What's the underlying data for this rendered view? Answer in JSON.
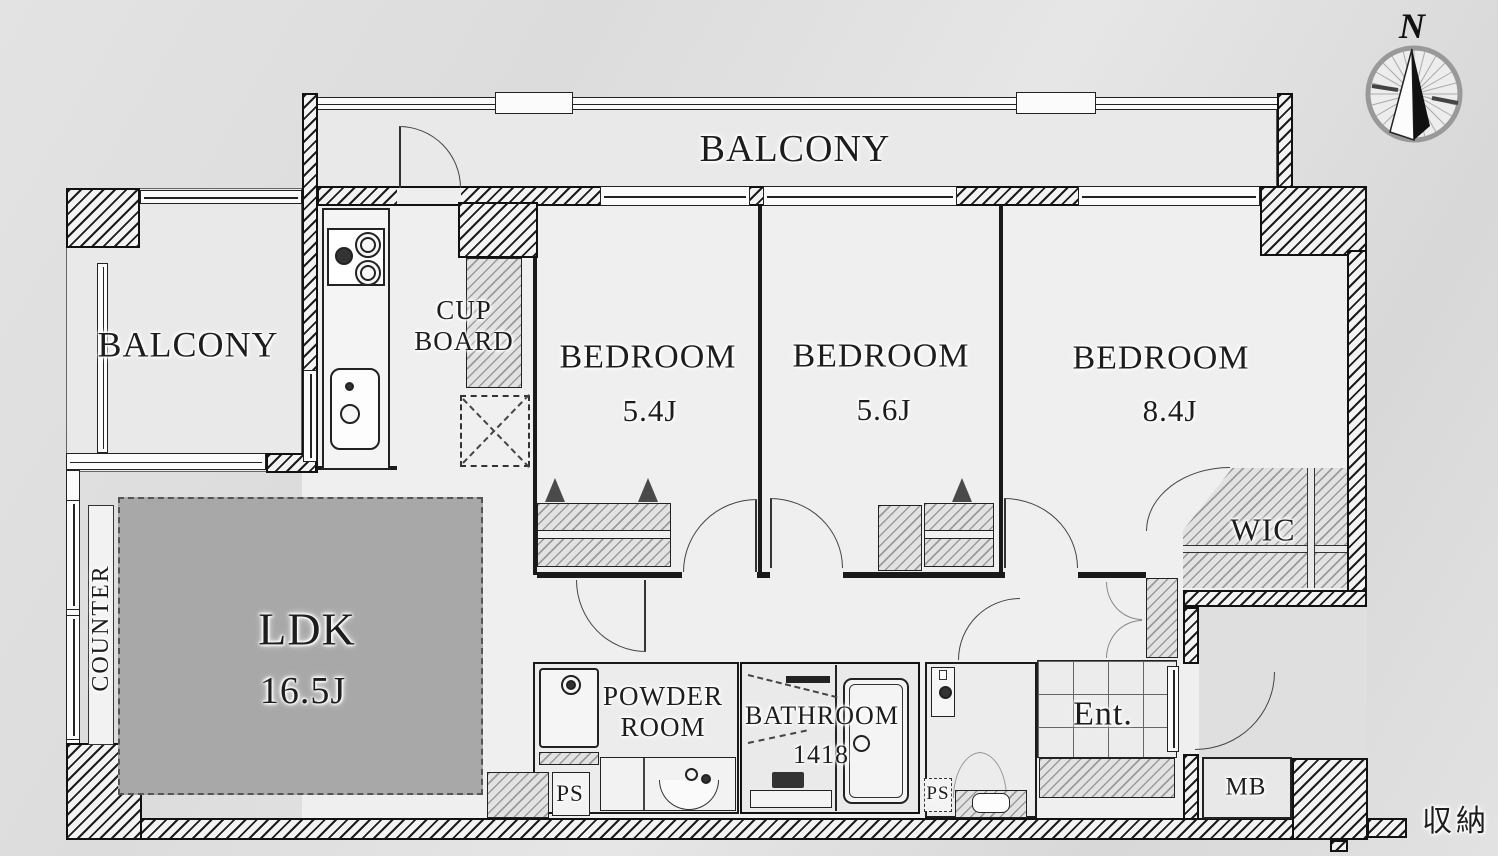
{
  "compass": {
    "north_label": "N"
  },
  "balcony_top": {
    "label": "BALCONY"
  },
  "balcony_left": {
    "label": "BALCONY"
  },
  "cupboard": {
    "line1": "CUP",
    "line2": "BOARD"
  },
  "bedroom_small": {
    "name": "BEDROOM",
    "size": "5.4J"
  },
  "bedroom_mid": {
    "name": "BEDROOM",
    "size": "5.6J"
  },
  "bedroom_large": {
    "name": "BEDROOM",
    "size": "8.4J"
  },
  "wic": {
    "label": "WIC"
  },
  "ldk": {
    "name": "LDK",
    "size": "16.5J"
  },
  "counter": {
    "label": "COUNTER"
  },
  "powder_room": {
    "line1": "POWDER",
    "line2": "ROOM"
  },
  "bathroom": {
    "name": "BATHROOM",
    "size": "1418"
  },
  "entrance": {
    "label": "Ent."
  },
  "ps_left": {
    "label": "PS"
  },
  "ps_right": {
    "label": "PS"
  },
  "meter_box": {
    "label": "MB"
  },
  "storage": {
    "label": "収納"
  },
  "colors": {
    "wall_ink": "#1a1a1a",
    "ldk_fill": "#a8a8a8",
    "floor": "#efefef",
    "outside": "#dfdfdf"
  }
}
